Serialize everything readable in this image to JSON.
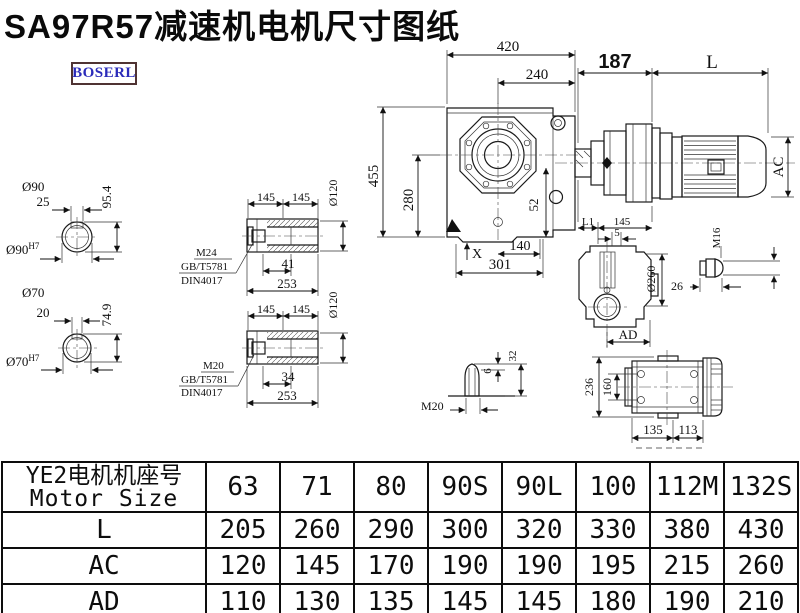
{
  "title": "SA97R57减速机电机尺寸图纸",
  "logo_text": "BOSERL",
  "drawing": {
    "front_view": {
      "dim_width_total": "420",
      "dim_width_flange": "240",
      "dim_adapter": "187",
      "dim_motor_length": "L",
      "dim_height_total": "455",
      "dim_height_axis": "280",
      "dim_52": "52",
      "x_mark": "X",
      "dim_140": "140",
      "dim_301": "301",
      "dim_motor_dia": "AC"
    },
    "shaft_solid_90": {
      "dia": "Ø90",
      "key_width": "25",
      "key_height": "95.4",
      "fit_base": "Ø90",
      "fit_sup": "H7"
    },
    "shaft_solid_70": {
      "dia": "Ø70",
      "key_width": "20",
      "key_height": "74.9",
      "fit_base": "Ø70",
      "fit_sup": "H7"
    },
    "hollow_shaft_top": {
      "dim_145_left": "145",
      "dim_145_right": "145",
      "dia": "Ø120",
      "thread": "M24",
      "std_gb": "GB/T5781",
      "std_din": "DIN4017",
      "dim_41": "41",
      "dim_253": "253"
    },
    "hollow_shaft_bottom": {
      "dim_145_left": "145",
      "dim_145_right": "145",
      "dia": "Ø120",
      "thread": "M20",
      "std_gb": "GB/T5781",
      "std_din": "DIN4017",
      "dim_34": "34",
      "dim_253": "253"
    },
    "side_view": {
      "dim_L1": "L1",
      "dim_145": "145",
      "dim_5": "5",
      "dia_260": "Ø260",
      "dim_AD": "AD"
    },
    "bolt_detail": {
      "thread": "M16",
      "dim_26": "26"
    },
    "plug_detail": {
      "thread": "M20",
      "dim_6": "6",
      "dim_32": "32"
    },
    "top_view": {
      "dim_236": "236",
      "dim_160": "160",
      "dim_135": "135",
      "dim_113": "113"
    }
  },
  "table": {
    "header_cn": "YE2电机机座号",
    "header_en": "Motor Size",
    "columns": [
      "63",
      "71",
      "80",
      "90S",
      "90L",
      "100",
      "112M",
      "132S"
    ],
    "rows": [
      {
        "label": "L",
        "values": [
          "205",
          "260",
          "290",
          "300",
          "320",
          "330",
          "380",
          "430"
        ]
      },
      {
        "label": "AC",
        "values": [
          "120",
          "145",
          "170",
          "190",
          "190",
          "195",
          "215",
          "260"
        ]
      },
      {
        "label": "AD",
        "values": [
          "110",
          "130",
          "135",
          "145",
          "145",
          "180",
          "190",
          "210"
        ]
      }
    ]
  },
  "colors": {
    "line": "#1a1a1a",
    "logo_text": "#2b2bba",
    "logo_border": "#4f3333"
  }
}
